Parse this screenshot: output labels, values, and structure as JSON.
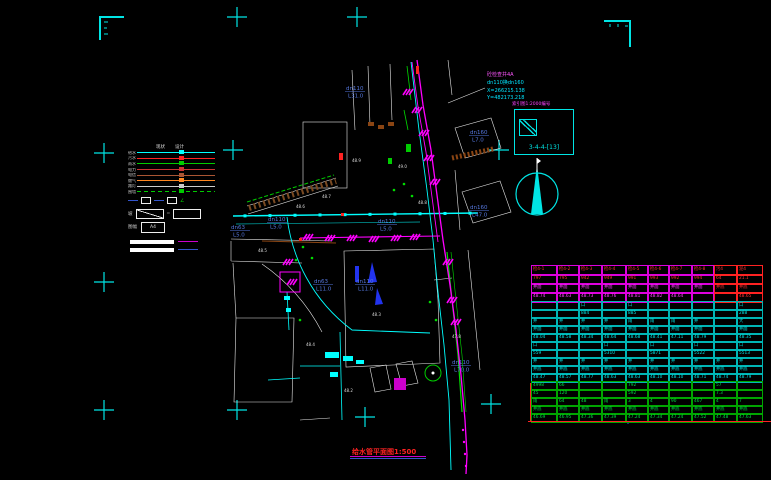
{
  "colors": {
    "bg": "#000000",
    "cyan": "#00ffff",
    "magenta": "#ff00ff",
    "green": "#00dd00",
    "red": "#ff2222",
    "blue_label": "#5577dd",
    "white": "#e8e8e8",
    "brown": "#8b4513",
    "orange": "#ff8822"
  },
  "title": {
    "text": "给水管平面图1:500"
  },
  "annotation": {
    "line1": "砼检查井4A",
    "line2": "dn110换dn160",
    "line3": "X=266215.138",
    "line4": "Y=482173.218"
  },
  "index": {
    "title": "索引图1:2000编号",
    "label": "3-4-4-[13]"
  },
  "north_arrow": {
    "name": "north-arrow"
  },
  "legend": {
    "header": {
      "col1": "现状",
      "col2": "设计"
    },
    "items": [
      {
        "label": "给水",
        "color": "#00ffff",
        "style": "solid"
      },
      {
        "label": "污水",
        "color": "#ff2222",
        "style": "solid"
      },
      {
        "label": "雨水",
        "color": "#00cc00",
        "style": "solid"
      },
      {
        "label": "电力",
        "color": "#cc3333",
        "style": "solid"
      },
      {
        "label": "电信",
        "color": "#aa5533",
        "style": "solid"
      },
      {
        "label": "燃气",
        "color": "#ff8822",
        "style": "solid"
      },
      {
        "label": "路灯",
        "color": "#cccccc",
        "style": "solid"
      },
      {
        "label": "围墙",
        "color": "#00cc00",
        "style": "dashed"
      }
    ],
    "slope": {
      "label": "坡",
      "eq": "="
    },
    "sheet": {
      "label": "图幅",
      "value": "A4"
    },
    "scale_bar": {
      "line1_color": "#cc00cc",
      "line2_color": "#3355cc"
    }
  },
  "pipe_labels": [
    {
      "t1": "dn110",
      "t2": "L31.0",
      "x": 346,
      "y": 90
    },
    {
      "t1": "dn63",
      "t2": "L5.0",
      "x": 231,
      "y": 229
    },
    {
      "t1": "dn110",
      "t2": "L5.0",
      "x": 268,
      "y": 221
    },
    {
      "t1": "dn110",
      "t2": "L5.0",
      "x": 378,
      "y": 223
    },
    {
      "t1": "dn63",
      "t2": "L11.0",
      "x": 314,
      "y": 283
    },
    {
      "t1": "dn110",
      "t2": "L11.0",
      "x": 356,
      "y": 283
    },
    {
      "t1": "dn160",
      "t2": "L7.0",
      "x": 470,
      "y": 134
    },
    {
      "t1": "dn160",
      "t2": "L47.0",
      "x": 470,
      "y": 209
    },
    {
      "t1": "dn110",
      "t2": "L70.0",
      "x": 452,
      "y": 364
    }
  ],
  "spots": [
    {
      "t": "48.6",
      "x": 296,
      "y": 208
    },
    {
      "t": "48.7",
      "x": 322,
      "y": 198
    },
    {
      "t": "48.9",
      "x": 352,
      "y": 162
    },
    {
      "t": "49.0",
      "x": 398,
      "y": 168
    },
    {
      "t": "48.5",
      "x": 258,
      "y": 252
    },
    {
      "t": "48.8",
      "x": 418,
      "y": 204
    },
    {
      "t": "48.3",
      "x": 372,
      "y": 316
    },
    {
      "t": "48.2",
      "x": 344,
      "y": 392
    },
    {
      "t": "47.8",
      "x": 452,
      "y": 338
    },
    {
      "t": "48.4",
      "x": 306,
      "y": 346
    }
  ],
  "table": {
    "sections": [
      {
        "border": "#dd00dd",
        "rows": [
          {
            "color": "#ff3333",
            "cells": [
              "检4-1",
              "检4-2",
              "检4-3",
              "检4-4",
              "检4-5",
              "检4-6",
              "检4-7",
              "检4-8",
              "污4",
              "泥4"
            ]
          },
          {
            "color": "#ff3333",
            "cells": [
              "797",
              "795",
              "942",
              "949",
              "991",
              "993",
              "992",
              "994",
              "64",
              "21.1"
            ]
          },
          {
            "color": "#ff44ff",
            "cells": [
              "井面",
              "井面",
              "井面",
              "井面",
              "井面",
              "井面",
              "井面",
              "井面",
              "井底",
              "井底"
            ]
          },
          {
            "color": "#ff44ff",
            "cells": [
              "48.74",
              "48.63",
              "48.73",
              "48.76",
              "48.81",
              "48.82",
              "48.64",
              "",
              "",
              "48.65"
            ]
          }
        ]
      },
      {
        "border": "#00b5b5",
        "rows": [
          {
            "color": "#00e5e5",
            "cells": [
              "",
              "",
              "口",
              "",
              "口",
              "",
              "",
              "",
              "",
              "口"
            ]
          },
          {
            "color": "#00e5e5",
            "cells": [
              "",
              "",
              "884",
              "",
              "885",
              "",
              "",
              "",
              "",
              "288"
            ]
          },
          {
            "color": "#00e5e5",
            "cells": [
              "井",
              "井",
              "井",
              "井",
              "雨",
              "雨",
              "雨",
              "井",
              "",
              "大"
            ]
          },
          {
            "color": "#00e5e5",
            "cells": [
              "井面",
              "井面",
              "井面",
              "井面",
              "井面",
              "井面",
              "井面",
              "井面",
              "",
              "井面"
            ]
          },
          {
            "color": "#00e5e5",
            "cells": [
              "48.04",
              "48.58",
              "48.34",
              "48.64",
              "48.68",
              "48.41",
              "47.11",
              "48.79",
              "",
              "48.35"
            ]
          },
          {
            "color": "#00e5e5",
            "cells": [
              "口",
              "",
              "",
              "口",
              "",
              "口",
              "",
              "口",
              "",
              "口"
            ]
          },
          {
            "color": "#00e5e5",
            "cells": [
              "559",
              "",
              "",
              "5310",
              "",
              "5871",
              "",
              "5522",
              "",
              "5513"
            ]
          },
          {
            "color": "#00e5e5",
            "cells": [
              "井",
              "井",
              "井",
              "井",
              "井",
              "井",
              "井",
              "井",
              "井",
              "井"
            ]
          },
          {
            "color": "#00e5e5",
            "cells": [
              "井底",
              "井底",
              "井底",
              "井底",
              "井底",
              "井底",
              "井底",
              "井底",
              "井底",
              "井底"
            ]
          },
          {
            "color": "#00e5e5",
            "cells": [
              "48.47",
              "48.57",
              "48.77",
              "48.63",
              "48.63",
              "48.10",
              "48.10",
              "48.71",
              "48.74",
              "48.79"
            ]
          }
        ]
      },
      {
        "border": "#00a500",
        "rows": [
          {
            "color": "#00dd44",
            "cells": [
              "4998",
              "66",
              "",
              "",
              "792",
              "",
              "",
              "",
              "57",
              ""
            ]
          },
          {
            "color": "#00dd44",
            "cells": [
              "45",
              "120",
              "",
              "",
              "592",
              "",
              "",
              "",
              "7.3",
              ""
            ]
          },
          {
            "color": "#00dd44",
            "cells": [
              "雨",
              "64",
              "48",
              "雨",
              "3",
              "4",
              "90",
              "467",
              "4",
              "7"
            ]
          },
          {
            "color": "#00dd44",
            "cells": [
              "井底",
              "井底",
              "井底",
              "井底",
              "井底",
              "井底",
              "井底",
              "井底",
              "井底",
              "井底"
            ]
          },
          {
            "color": "#00dd44",
            "cells": [
              "46.69",
              "46.95",
              "47.36",
              "47.39",
              "47.24",
              "47.34",
              "47.24",
              "47.52",
              "47.48",
              "47.63"
            ]
          }
        ]
      }
    ]
  }
}
